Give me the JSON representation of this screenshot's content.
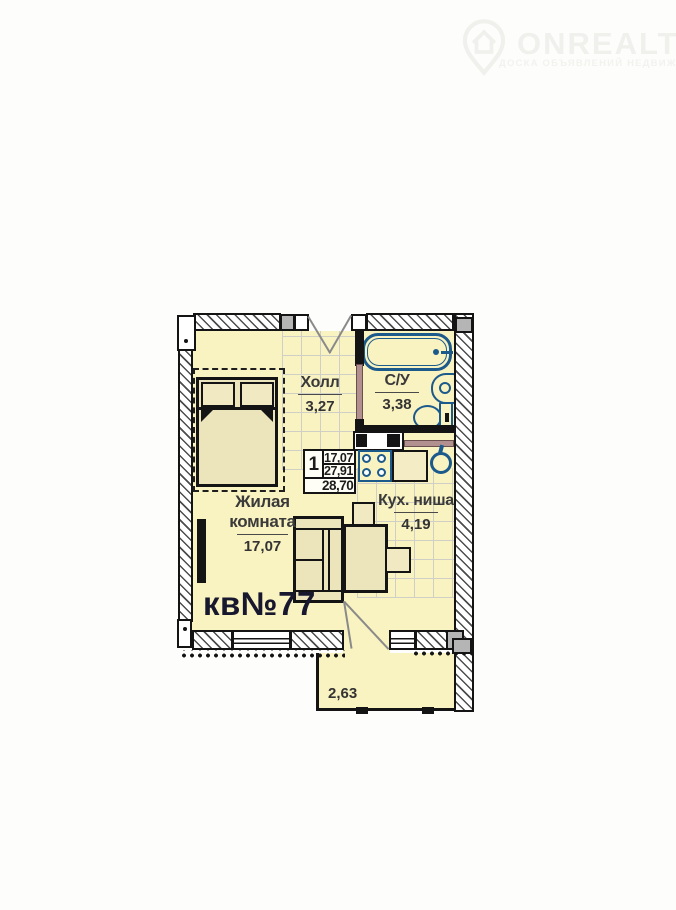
{
  "watermark": {
    "brand": "ONREALT",
    "tagline": "ДОСКА ОБЪЯВЛЕНИЙ НЕДВИЖИМОСТИ",
    "logo": "location-pin-house-icon"
  },
  "plan": {
    "apartment_label": "кв№77",
    "rooms": {
      "hall": {
        "name": "Холл",
        "area": "3,27"
      },
      "bathroom": {
        "name": "С/У",
        "area": "3,38"
      },
      "living": {
        "name": "Жилая комната",
        "area": "17,07"
      },
      "kitchen": {
        "name": "Кух. ниша",
        "area": "4,19"
      },
      "balcony": {
        "area": "2,63"
      }
    },
    "stamp": {
      "rooms_count": "1",
      "living_area": "17,07",
      "apartment_area": "27,91",
      "total_area": "28,70"
    },
    "colors": {
      "floor": "#f9f2c1",
      "furniture": "#ece4ba",
      "wall": "#141414",
      "fixture_blue": "#1d5a8c",
      "tile_line": "#cfcfc6",
      "door_brown": "#b29090",
      "label_text": "#3a3a3a",
      "apartment_label": "#17172e"
    }
  }
}
